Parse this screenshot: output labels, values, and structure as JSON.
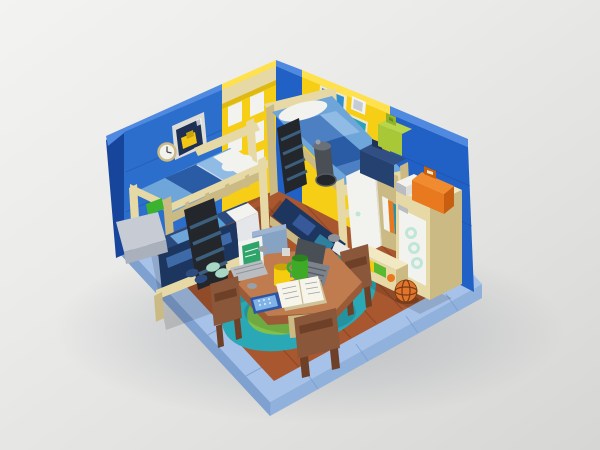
{
  "scene": {
    "subject": "Brick-built (LEGO-style) bedroom diorama render",
    "description": "Isometric studio render of a toy-brick kids bedroom: two tan bunk beds with blue/white bedding against a blue left wall (with picture frame, clock and yellow lattice window) and a blue/yellow right wall (with two map posters), a round brown study table on a teal-and-green rug with two laptops, mugs, an open notebook and a smartphone, brown chairs, a storage cabinet with suitcases, a drawer box and a basketball, all standing on a light-blue tiled base over a wooden plank floor on a plain light-gray backdrop.",
    "background": "plain light-gray studio backdrop"
  },
  "colors": {
    "baseTop": "#a6c2e8",
    "baseSideSW": "#7fa1d0",
    "baseSideSE": "#90b1dc",
    "baseSeam": "#7b9cce",
    "floor": "#a8572f",
    "floorLine": "#8a4424",
    "rugOuter": "#2ba8b6",
    "rugInner": "#7fc14b",
    "wallBlue": "#2c6ecb",
    "wallBlueRight": "#2161c5",
    "wallBlueDark": "#17459c",
    "wallBlueCap": "#4f89e0",
    "yellow": "#f6ce15",
    "yellowCap": "#ffe14e",
    "yellowDark": "#d8a90b",
    "tan": "#e7d9a6",
    "tanDark": "#cbba84",
    "tanLight": "#f2e8c2",
    "white": "#f2f2ee",
    "whiteDim": "#dddcd6",
    "grayLight": "#c6cbd4",
    "gray": "#9aa0a8",
    "graySteel": "#b9bdc2",
    "grayDark": "#4a4f55",
    "navy": "#24416f",
    "navyDeep": "#1d3660",
    "medBlue": "#4c80c2",
    "skyBlue": "#6fa6d9",
    "paleBlue": "#8fbbe4",
    "steelBlue": "#3c5f7d",
    "black": "#23272c",
    "green": "#3cb32e",
    "lime": "#a8c838",
    "limeDark": "#8fb32a",
    "mugGreen": "#3faa28",
    "mugYellow": "#f5cd0e",
    "mint": "#bfe6d8",
    "mintPale": "#a7d8c6",
    "orange": "#e8791f",
    "orangeLight": "#f18b30",
    "orangeDark": "#c85f10",
    "ballOrange": "#e0762d",
    "ballLine": "#7a3a12",
    "table": "#c07c4e",
    "tableSide": "#9c5b36",
    "chair": "#8a573a",
    "chairDark": "#6e4027",
    "chairBlue": "#87a3c4",
    "posterBlue": "#2f8fd2",
    "posterTeal": "#2aa3b8",
    "posterGreen": "#57b33e",
    "screenGreen": "#2fa46a",
    "phoneBlue": "#2e55a4",
    "phoneScreen": "#7fb3e8",
    "bookPage": "#f7f4ea",
    "bookEdge": "#cfc39a"
  },
  "objects": {
    "backdrop": "light gray studio background",
    "baseplate": "light blue tiled base border",
    "wood-floor": "reddish-brown wooden plank floor",
    "rug": "round teal rug with green center",
    "left-wall": "blue brick wall",
    "window-lattice": "yellow lattice window section",
    "picture-frame": "framed picture of a yellow digger",
    "wall-clock": "round wall clock",
    "right-wall": "blue and yellow brick wall",
    "poster-map-1": "blue map poster",
    "poster-map-2": "teal map poster",
    "wall-white-frame": "small white wall frame",
    "bunk-bed-left": "tan bunk bed with blue and white bedding",
    "bunk-bed-left-ladder": "dark bunk-bed ladder",
    "bunk-bed-right": "tan bunk bed with checkered blue bedding",
    "bunk-bed-right-ladder": "dark bunk-bed ladder",
    "telescope": "dark gray telescope on bed rail",
    "wardrobe-door": "white wardrobe door",
    "bookshelf": "tan shelf with books",
    "suitcase-lime": "lime suitcase",
    "suitcase-navy": "navy suitcase",
    "suitcase-orange": "orange suitcase",
    "mini-case-white": "small white case",
    "storage-cabinet": "tan cabinet with white door and mint hooks",
    "drawer-box": "drawer box with colorful contents",
    "basketball": "orange basketball",
    "study-table": "round brown study table",
    "laptop-white": "white laptop with green screen",
    "laptop-gray": "dark gray laptop",
    "mug-yellow": "yellow mug",
    "mug-green": "green mug",
    "notebook-open": "open notebook",
    "smartphone": "blue smartphone",
    "chair-blue-back": "light blue chair",
    "chair-brown-left": "brown chair",
    "chair-brown-front": "brown chair",
    "chair-brown-right": "brown chair",
    "slippers-navy": "navy slippers",
    "slippers-mint": "mint slippers",
    "green-brick": "green brick",
    "gray-slope": "gray sloped piece",
    "desk-stones": "small gray pieces"
  }
}
